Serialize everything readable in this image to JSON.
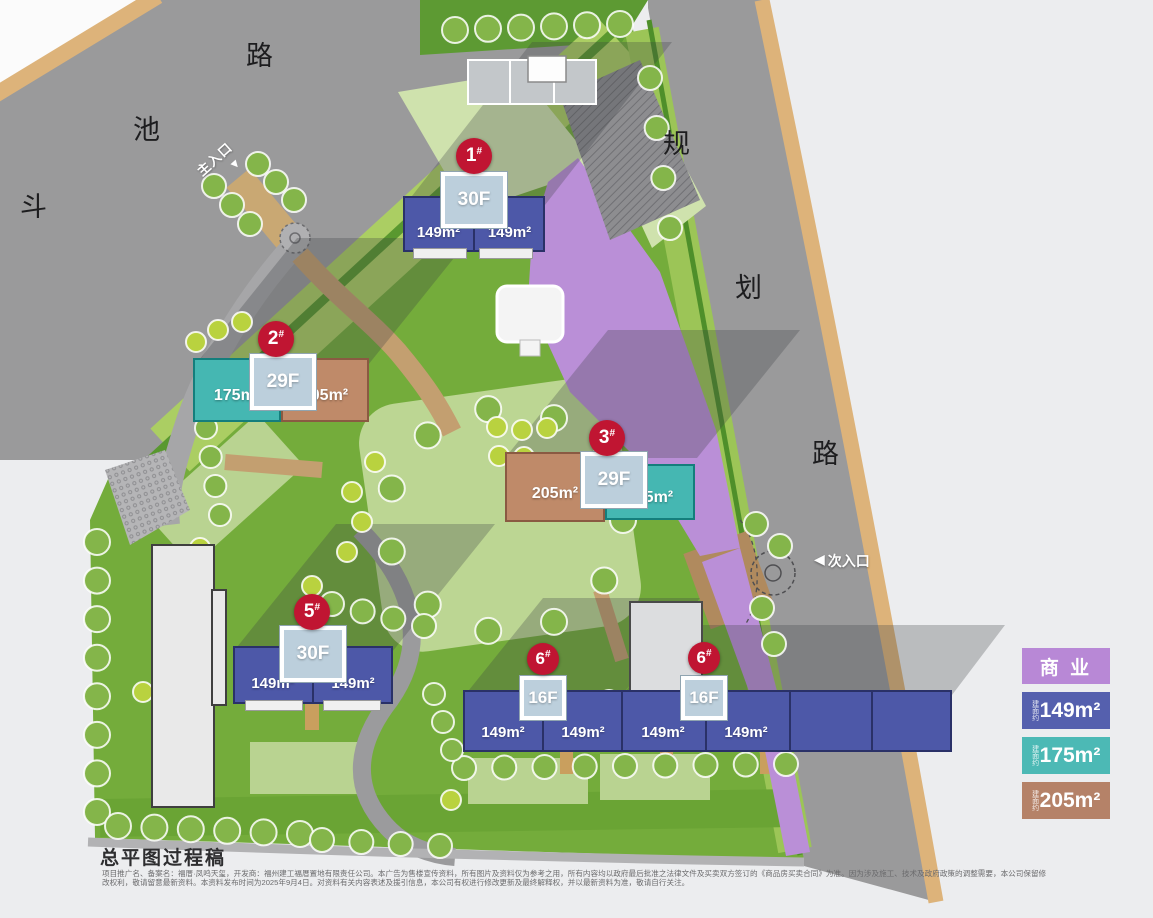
{
  "roads": {
    "left_road": {
      "chars": [
        "斗",
        "池",
        "路"
      ]
    },
    "right_road": {
      "chars": [
        "规",
        "划",
        "路"
      ]
    }
  },
  "entrances": {
    "main": {
      "label": "主入口",
      "arrow": "▼"
    },
    "secondary": {
      "label": "次入口",
      "arrow": "◀"
    }
  },
  "buildings": [
    {
      "badge": "1",
      "hash": "#",
      "floors": "30F",
      "units": [
        "149m²",
        "149m²"
      ]
    },
    {
      "badge": "2",
      "hash": "#",
      "floors": "29F",
      "units": [
        "175m²",
        "205m²"
      ]
    },
    {
      "badge": "3",
      "hash": "#",
      "floors": "29F",
      "units": [
        "205m²",
        "175m²"
      ]
    },
    {
      "badge": "5",
      "hash": "#",
      "floors": "30F",
      "units": [
        "149m²",
        "149m²"
      ]
    },
    {
      "badge": "6",
      "hash": "#",
      "floors": "16F",
      "units": [
        "149m²",
        "149m²"
      ]
    },
    {
      "badge": "6",
      "hash": "#",
      "floors": "16F",
      "units": [
        "149m²",
        "149m²"
      ]
    }
  ],
  "legend": {
    "commercial_label": "商 业",
    "area_prefix": "建面约",
    "areas": [
      {
        "label": "149m²"
      },
      {
        "label": "175m²"
      },
      {
        "label": "205m²"
      }
    ]
  },
  "palette": {
    "residential_149": "#4d58a8",
    "unit_175": "#45b7b2",
    "unit_205": "#bf8a69",
    "commercial": "#ba8fd7",
    "badge_red": "#c01532",
    "core_box": "#bccfdc",
    "legend_commercial": "#b888d6",
    "legend_149": "#5560ae",
    "legend_175": "#4cb9b5",
    "legend_205": "#b58268"
  },
  "footer": {
    "title": "总平图过程稿",
    "disclaimer": "项目推广名、备案名：福厝·凤鸣天玺，开发商：福州建工福厝置地有限责任公司。本广告为售楼宣传资料，所有图片及资料仅为参考之用，所有内容均以政府最后批准之法律文件及买卖双方签订的《商品房买卖合同》为准。因为涉及施工、技术及政府政策的调整需要，本公司保留修改权利，敬请留意最新资料。本资料发布时间为2025年9月4日。对资料有关内容表述及援引信息，本公司有权进行修改更新及最终解释权，并以最新资料为准，敬请自行关注。"
  }
}
